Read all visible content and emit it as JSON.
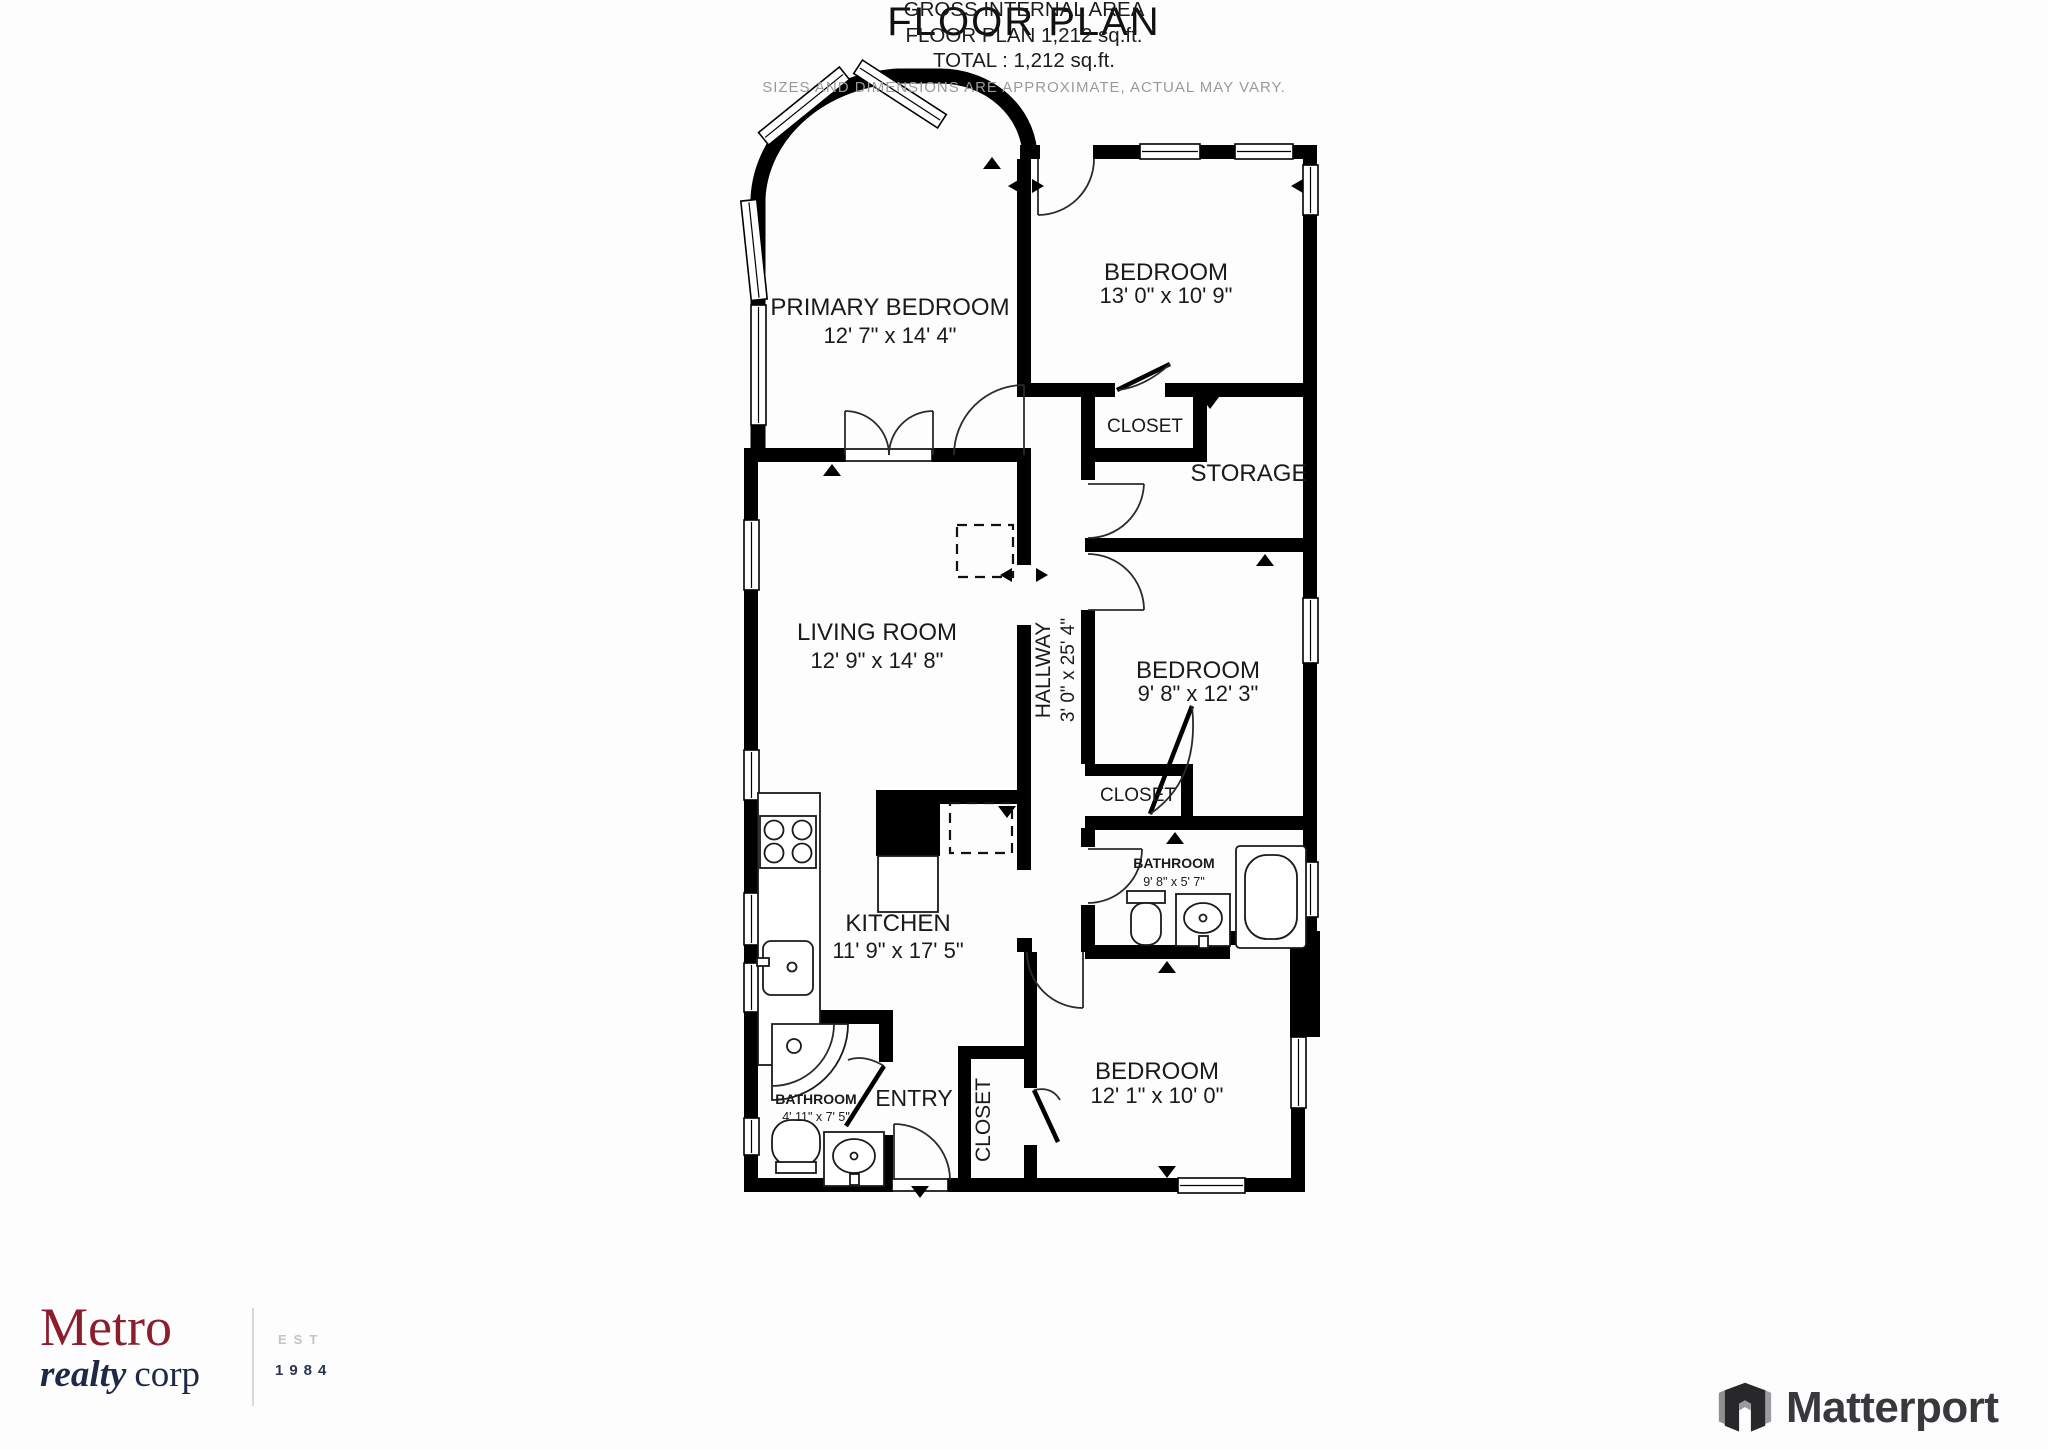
{
  "plan": {
    "title": "FLOOR PLAN",
    "rooms": [
      {
        "name": "PRIMARY BEDROOM",
        "dims": "12' 7\" x 14' 4\""
      },
      {
        "name": "BEDROOM",
        "dims": "13' 0\" x 10' 9\""
      },
      {
        "name": "CLOSET"
      },
      {
        "name": "STORAGE"
      },
      {
        "name": "LIVING ROOM",
        "dims": "12' 9\" x 14' 8\""
      },
      {
        "name": "HALLWAY",
        "dims": "3' 0\" x 25' 4\""
      },
      {
        "name": "BEDROOM",
        "dims": "9' 8\" x 12' 3\""
      },
      {
        "name": "CLOSET"
      },
      {
        "name": "BATHROOM",
        "dims": "9' 8\" x 5' 7\""
      },
      {
        "name": "KITCHEN",
        "dims": "11' 9\" x 17' 5\""
      },
      {
        "name": "BATHROOM",
        "dims": "4' 11\" x 7' 5\""
      },
      {
        "name": "ENTRY"
      },
      {
        "name": "CLOSET"
      },
      {
        "name": "BEDROOM",
        "dims": "12' 1\" x 10' 0\""
      }
    ]
  },
  "footer": {
    "line1": "GROSS INTERNAL AREA",
    "line2": "FLOOR PLAN 1,212 sq.ft.",
    "line3": "TOTAL :  1,212 sq.ft.",
    "disclaimer": "SIZES AND DIMENSIONS ARE APPROXIMATE, ACTUAL MAY VARY."
  },
  "metro_logo": {
    "name": "Metro",
    "sub_italic": "realty",
    "sub_regular": "corp",
    "est_label": "EST",
    "est_year": "1984"
  },
  "matterport_logo": {
    "label": "Matterport"
  },
  "colors": {
    "wall": "#000000",
    "metro_red": "#8b1e2c",
    "metro_navy": "#1f2847",
    "matterport_gray": "#39393d",
    "disclaimer_gray": "#9a9a9a",
    "background": "#fdfdfd"
  }
}
